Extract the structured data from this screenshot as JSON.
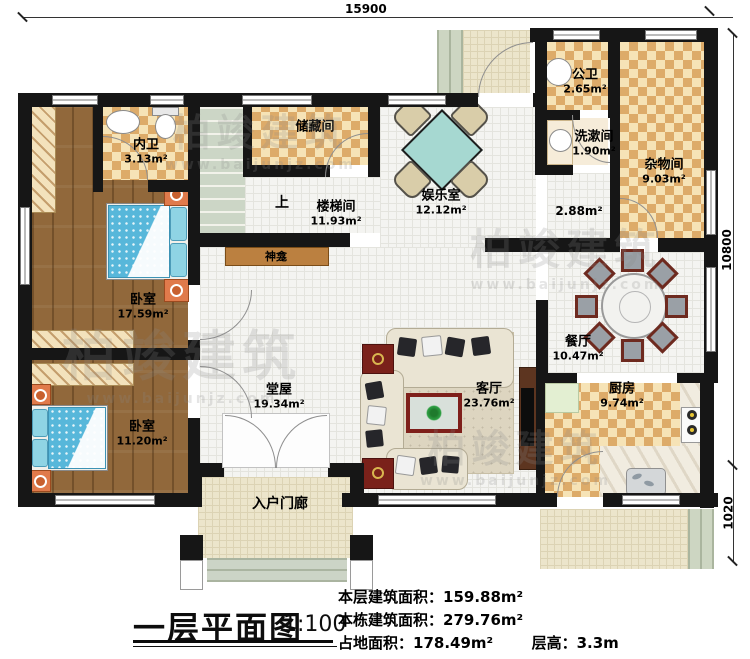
{
  "dimensions": {
    "top": "15900",
    "right_upper": "10800",
    "right_lower": "1020"
  },
  "rooms": [
    {
      "name": "内卫",
      "area": "3.13m²"
    },
    {
      "name": "储藏间",
      "area": ""
    },
    {
      "name": "楼梯间",
      "area": "11.93m²"
    },
    {
      "name": "娱乐室",
      "area": "12.12m²"
    },
    {
      "name": "公卫",
      "area": "2.65m²"
    },
    {
      "name": "洗漱间",
      "area": "1.90m²"
    },
    {
      "name": "杂物间",
      "area": "9.03m²"
    },
    {
      "name": "卧室",
      "area": "17.59m²"
    },
    {
      "name": "卧室",
      "area": "11.20m²"
    },
    {
      "name": "堂屋",
      "area": "19.34m²"
    },
    {
      "name": "客厅",
      "area": "23.76m²"
    },
    {
      "name": "餐厅",
      "area": "10.47m²"
    },
    {
      "name": "厨房",
      "area": "9.74m²"
    },
    {
      "name": "入户门廊",
      "area": ""
    }
  ],
  "annotations": {
    "up": "上",
    "shrine": "神龛",
    "corridor_area": "2.88m²"
  },
  "title": {
    "text": "一层平面图",
    "scale": "1:100"
  },
  "stats": {
    "line1_label": "本层建筑面积：",
    "line1_value": "159.88m²",
    "line2_label": "本栋建筑面积：",
    "line2_value": "279.76m²",
    "line3_label": "占地面积：",
    "line3_value": "178.49m²",
    "line4_label": "层高：",
    "line4_value": "3.3m"
  },
  "watermark": {
    "brand": "柏竣建筑",
    "url": "www.baijunjz.com"
  },
  "colors": {
    "wall": "#161616",
    "checker": "#ddab69",
    "wood": "#91683b",
    "accent_bed": "#57b7da"
  }
}
